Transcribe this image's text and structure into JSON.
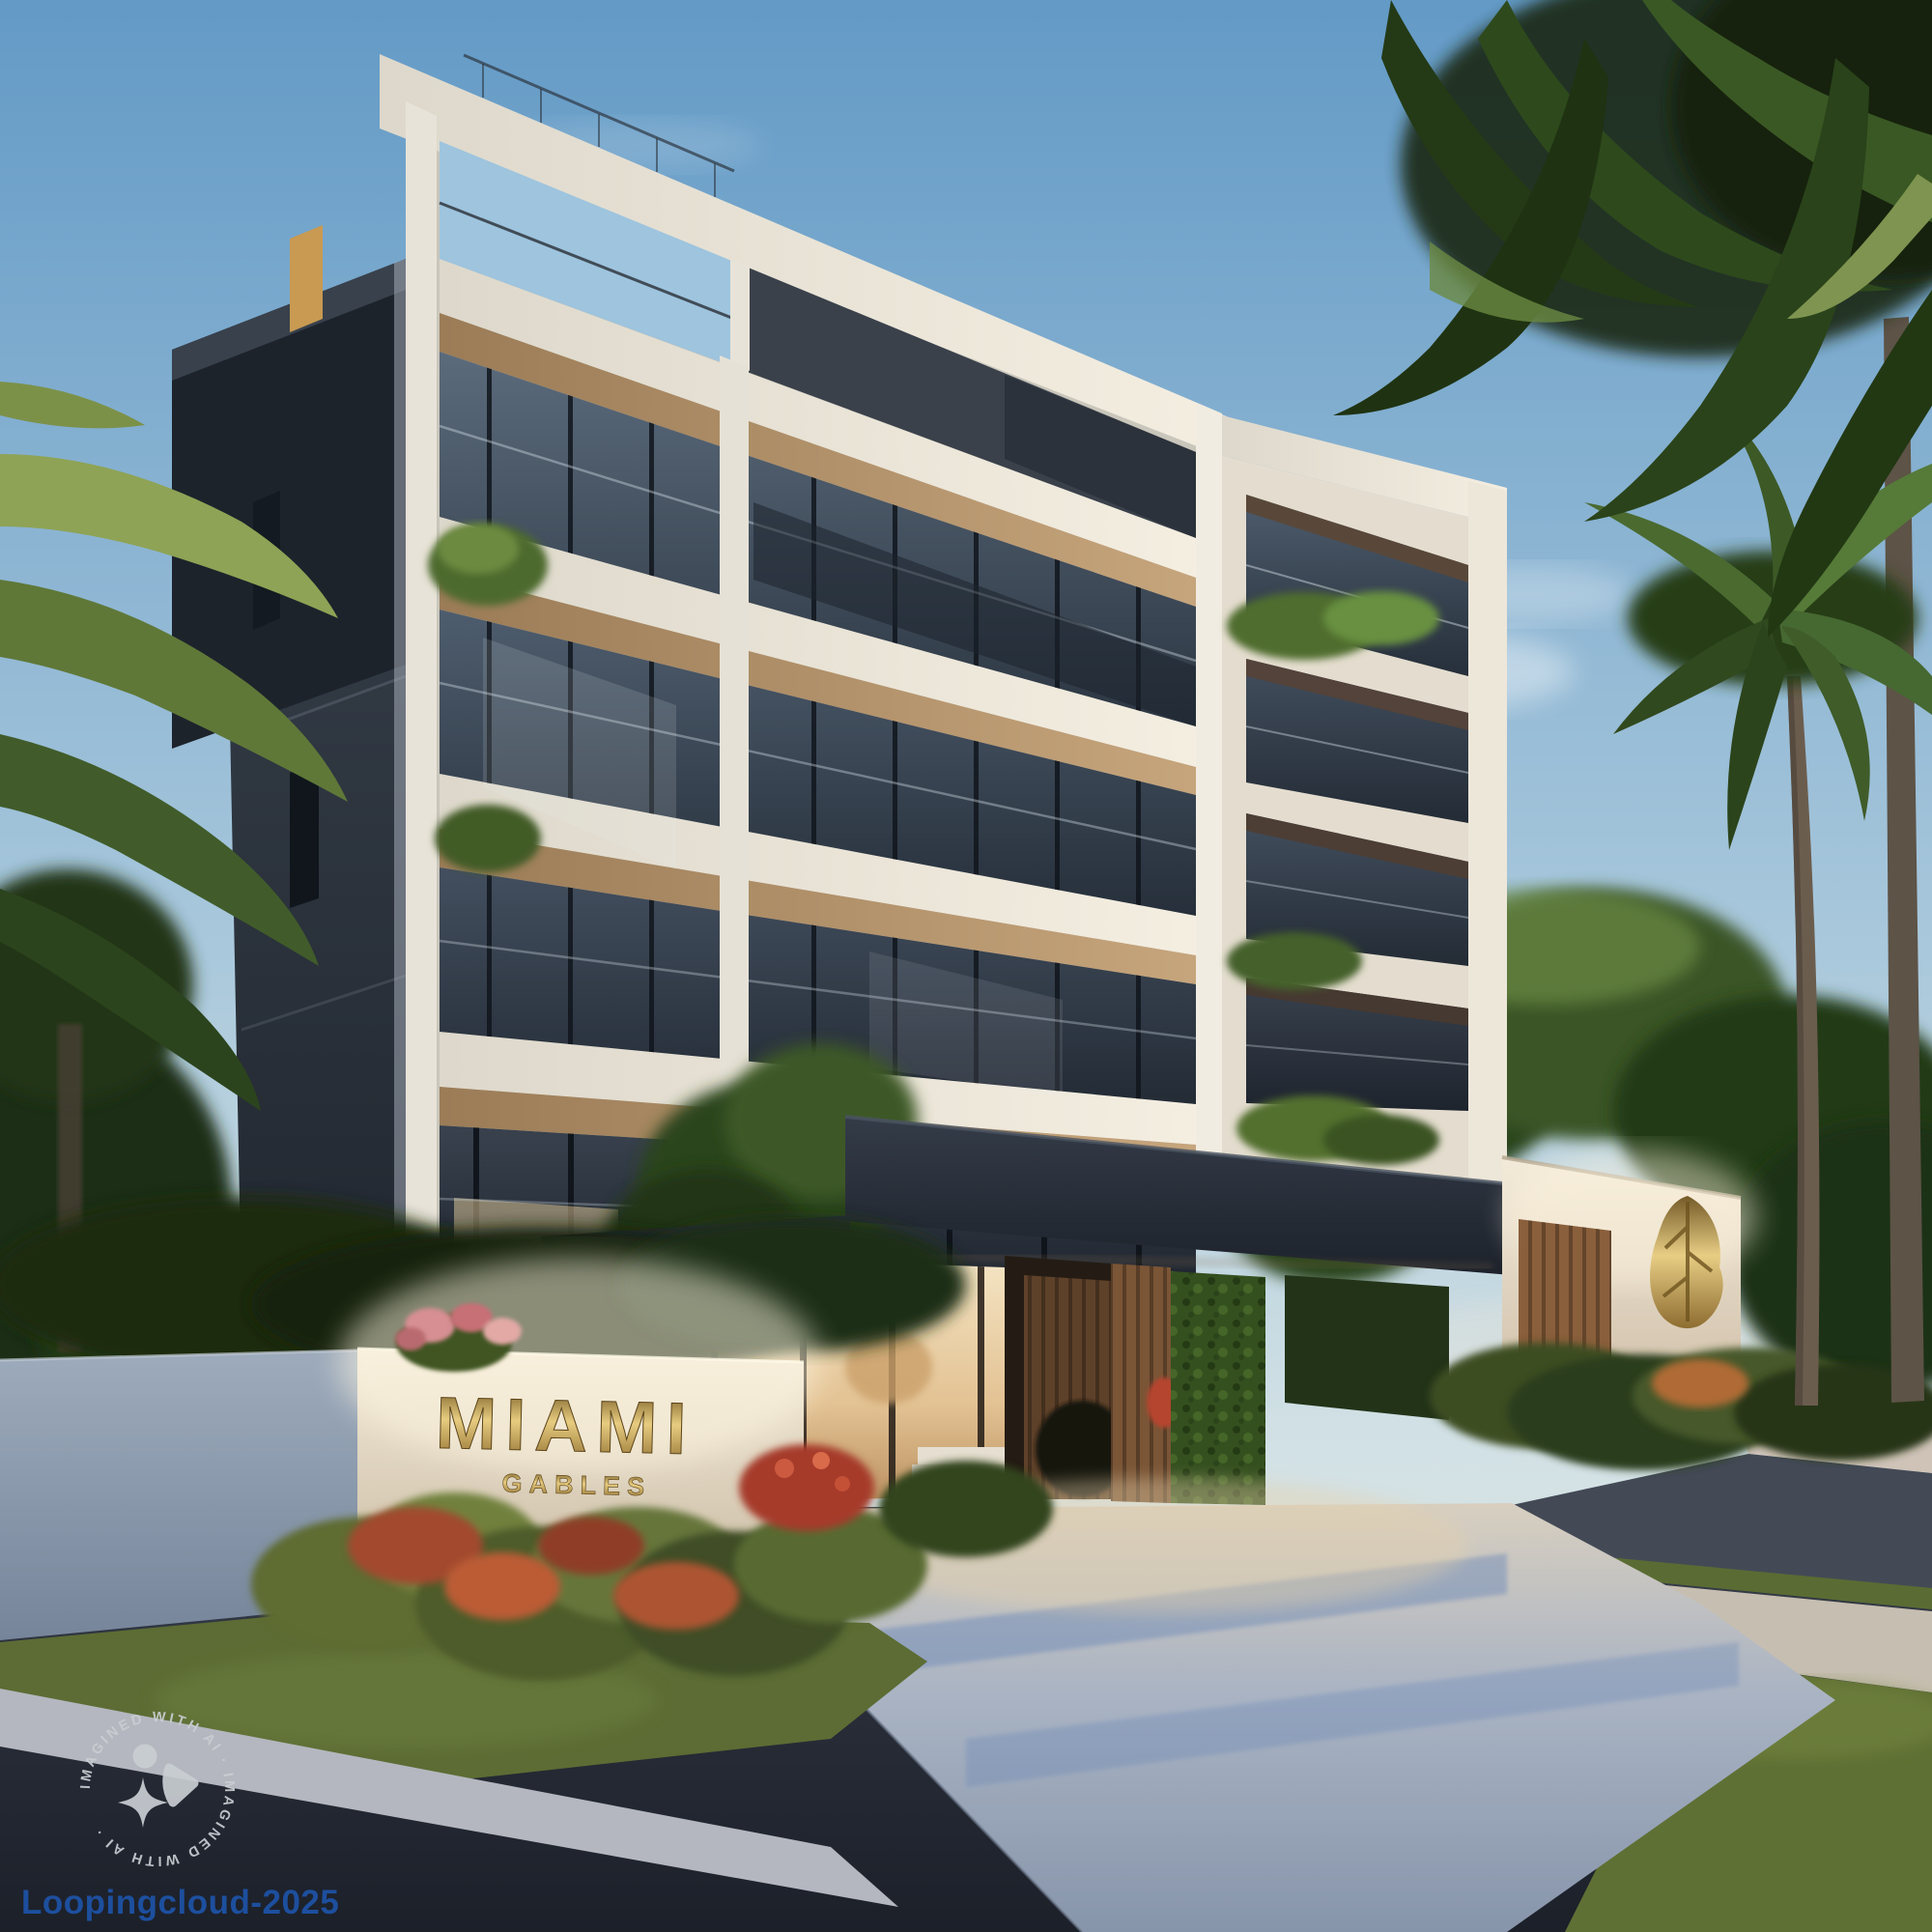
{
  "sign": {
    "line1": "MIAMI",
    "line2": "GABLES",
    "gold_color": "#c9a85c"
  },
  "watermark": {
    "ring_text": "IMAGINED WITH AI   ·   IMAGINED WITH AI   ·",
    "badge_icon_color": "#c9ced3"
  },
  "credit": {
    "label": "Loopingcloud-2025",
    "color": "#1d4f9e"
  },
  "palette": {
    "sky_top": "#69a1cb",
    "sky_horizon": "#dde7e3",
    "foliage_dark": "#1d2f14",
    "foliage_light": "#7f9c50",
    "facade_white": "#efe9dd",
    "wood": "#ab8a5f",
    "glass_dark": "#232b35",
    "canopy_dark": "#262c36",
    "interior_warm": "#f0dcb4",
    "asphalt": "#262b34",
    "walkway": "#aab4c4",
    "lawn": "#6e7f3e"
  }
}
